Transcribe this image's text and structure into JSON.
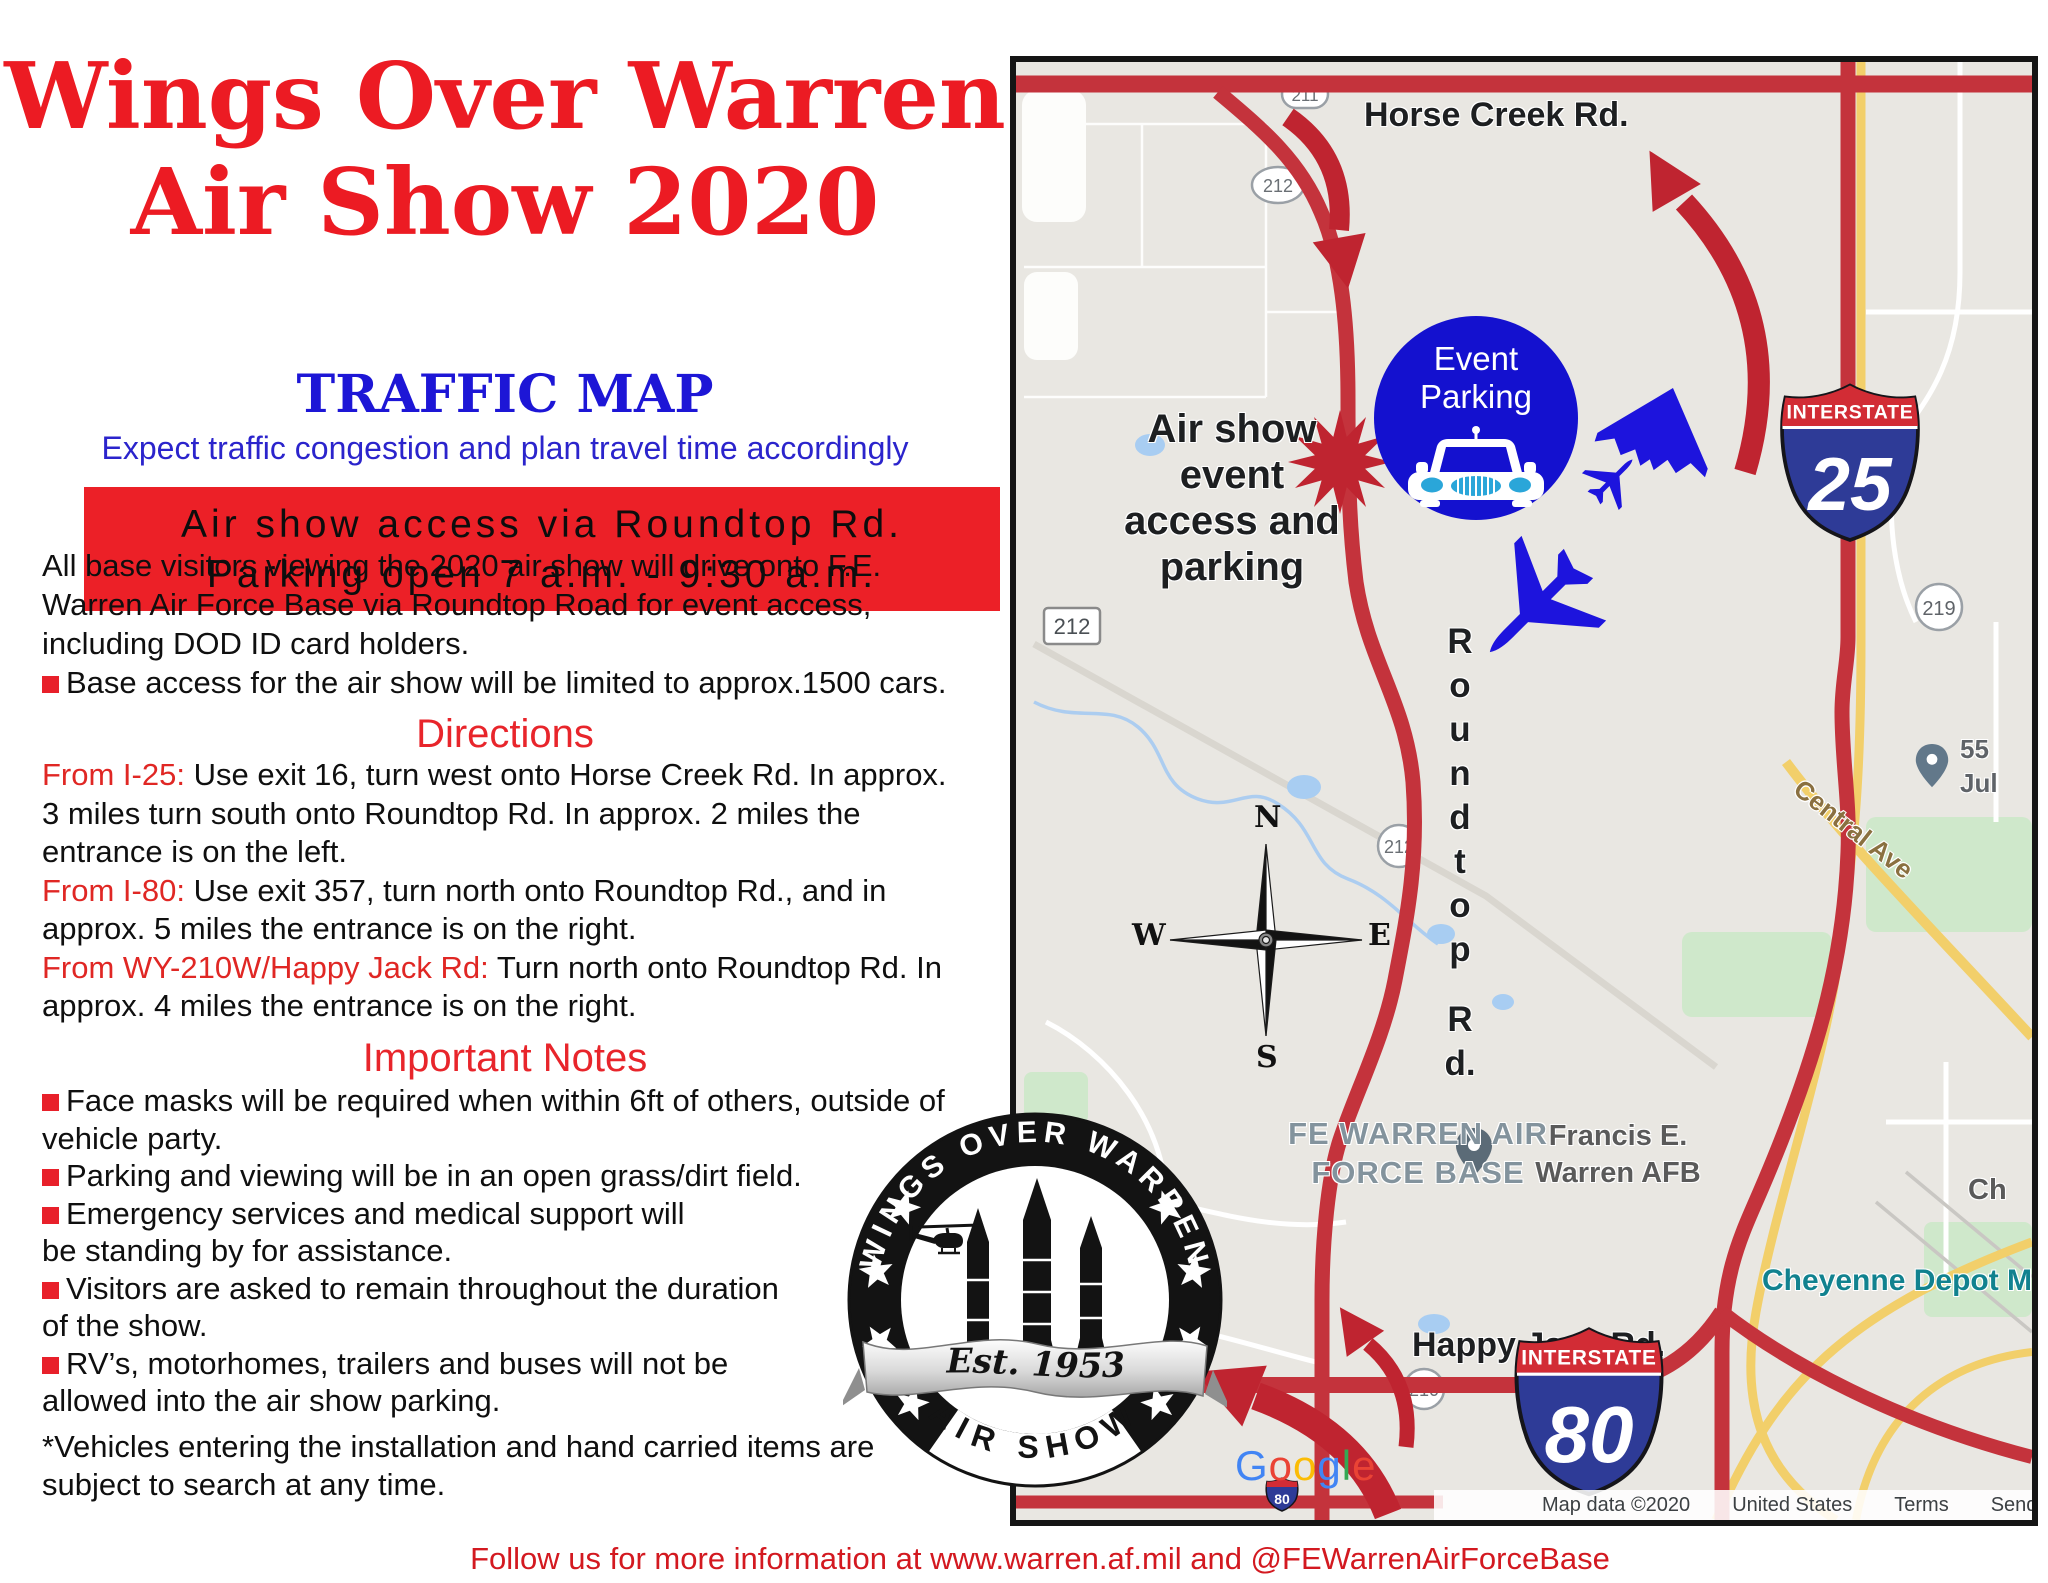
{
  "colors": {
    "title_red": "#ec1b23",
    "banner_red": "#ec2027",
    "heading_red": "#e8252b",
    "blue_heading": "#1d16d6",
    "blue_tagline": "#2b24cc",
    "map_road_red": "#c4333c",
    "arrow_red": "#bf2430",
    "event_blue": "#1411cf",
    "aircraft_blue": "#1d14dd",
    "map_bg": "#e9e7e2",
    "teal_label": "#11828f"
  },
  "header": {
    "title1": "Wings Over Warren",
    "title2": "Air Show 2020",
    "subtitle": "TRAFFIC MAP",
    "tagline": "Expect traffic congestion and plan travel time accordingly"
  },
  "banner": {
    "line1": "Air show access via Roundtop Rd.",
    "line2": "Parking open 7 a.m. - 9:30 a.m."
  },
  "intro": {
    "lines": [
      "All base visitors viewing the 2020 air show will drive onto F.E.",
      "Warren Air Force Base via Roundtop Road for event access,",
      "including DOD ID card holders."
    ],
    "bullet": "Base access for the air show will be limited to approx.1500 cars."
  },
  "directions": {
    "heading": "Directions",
    "lines": [
      {
        "lead": "From I-25:",
        "text": " Use exit 16, turn west onto Horse Creek Rd. In approx."
      },
      {
        "lead": "",
        "text": "3 miles turn south onto Roundtop Rd. In approx. 2 miles the"
      },
      {
        "lead": "",
        "text": "entrance is on the left."
      },
      {
        "lead": "From I-80:",
        "text": " Use exit 357, turn north onto Roundtop Rd., and in"
      },
      {
        "lead": "",
        "text": "approx. 5 miles the entrance is on the right."
      },
      {
        "lead": "From WY-210W/Happy Jack Rd:",
        "text": " Turn north onto Roundtop Rd. In"
      },
      {
        "lead": "",
        "text": "approx. 4 miles the entrance is on the right."
      }
    ]
  },
  "notes": {
    "heading": "Important Notes",
    "lines": [
      {
        "bullet": true,
        "text": "Face masks will be required when within 6ft of others, outside of"
      },
      {
        "bullet": false,
        "text": "vehicle party."
      },
      {
        "bullet": true,
        "text": "Parking and viewing will be in an open grass/dirt field."
      },
      {
        "bullet": true,
        "text": "Emergency services and medical support  will"
      },
      {
        "bullet": false,
        "text": "be standing by for assistance."
      },
      {
        "bullet": true,
        "text": "Visitors are asked to remain throughout the duration"
      },
      {
        "bullet": false,
        "text": "of the show."
      },
      {
        "bullet": true,
        "text": "RV’s, motorhomes, trailers and buses will not be"
      },
      {
        "bullet": false,
        "text": "allowed into the air show parking."
      }
    ]
  },
  "disclaimer": {
    "lines": [
      "*Vehicles entering the installation and hand carried items are",
      "subject to search at any time."
    ]
  },
  "footer": "Follow us for more information at www.warren.af.mil and @FEWarrenAirForceBase",
  "map": {
    "labels": {
      "horse_creek": "Horse Creek Rd.",
      "happy_jack": "Happy Jack Rd.",
      "access": [
        "Air show",
        "event",
        "access and",
        "parking"
      ],
      "roundtop": [
        "R",
        "o",
        "u",
        "n",
        "d",
        "t",
        "o",
        "p",
        "R",
        "d."
      ],
      "fe_warren": [
        "FE WARREN AIR",
        "FORCE BASE"
      ],
      "francis": [
        "Francis E.",
        "Warren AFB"
      ],
      "cheyenne": "Cheyenne Depot Mu",
      "ch": "Ch",
      "poi_55": "55",
      "poi_jul": "Jul",
      "central_ave": "Central Ave"
    },
    "shields": {
      "i25": {
        "system": "INTERSTATE",
        "number": "25"
      },
      "i80": {
        "system": "INTERSTATE",
        "number": "80"
      },
      "mini80": "80",
      "r211": "211",
      "r212_oval": "212",
      "r212_box": "212",
      "r212_circle": "212",
      "r219": "219",
      "r210": "210"
    },
    "event_parking": {
      "line1": "Event",
      "line2": "Parking"
    },
    "compass": {
      "n": "N",
      "s": "S",
      "e": "E",
      "w": "W"
    },
    "google": [
      "G",
      "o",
      "o",
      "g",
      "l",
      "e"
    ],
    "attribution": [
      "Map data ©2020",
      "United States",
      "Terms",
      "Send feedback"
    ]
  },
  "seal": {
    "top": "WINGS OVER WARREN",
    "est": "Est. 1953",
    "bottom": "AIR SHOW"
  }
}
